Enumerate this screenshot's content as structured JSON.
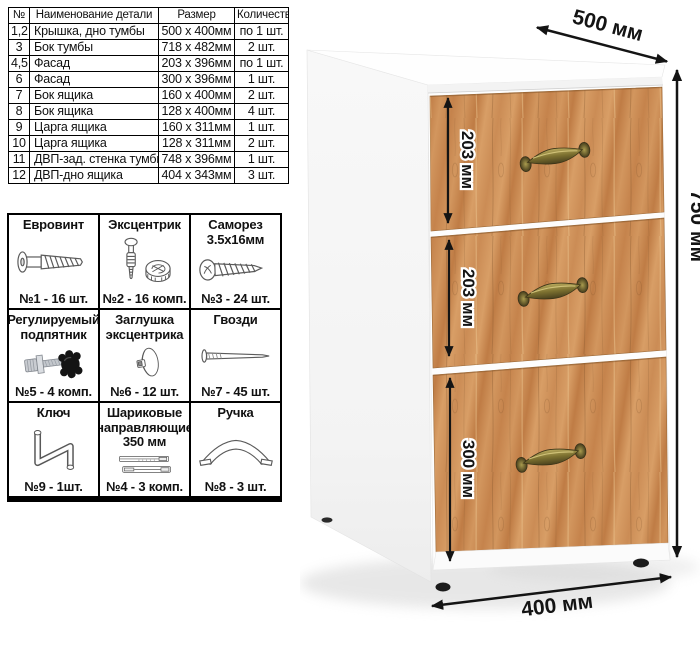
{
  "parts_table": {
    "headers": [
      "№",
      "Наименование детали",
      "Размер",
      "Количество"
    ],
    "rows": [
      [
        "1,2",
        "Крышка, дно тумбы",
        "500 х 400мм",
        "по 1 шт."
      ],
      [
        "3",
        "Бок тумбы",
        "718 х 482мм",
        "2 шт."
      ],
      [
        "4,5",
        "Фасад",
        "203 х 396мм",
        "по 1 шт."
      ],
      [
        "6",
        "Фасад",
        "300 х 396мм",
        "1 шт."
      ],
      [
        "7",
        "Бок ящика",
        "160 х 400мм",
        "2 шт."
      ],
      [
        "8",
        "Бок ящика",
        "128 х 400мм",
        "4 шт."
      ],
      [
        "9",
        "Царга ящика",
        "160 х 311мм",
        "1 шт."
      ],
      [
        "10",
        "Царга ящика",
        "128 х 311мм",
        "2 шт."
      ],
      [
        "11",
        "ДВП-зад. стенка тумбы",
        "748 х 396мм",
        "1 шт."
      ],
      [
        "12",
        "ДВП-дно ящика",
        "404 х 343мм",
        "3 шт."
      ]
    ]
  },
  "hardware": {
    "cells": [
      {
        "icon": "euro-screw",
        "title_lines": [
          "Евровинт"
        ],
        "count": "№1 - 16 шт."
      },
      {
        "icon": "cam-lock",
        "title_lines": [
          "Эксцентрик"
        ],
        "count": "№2 - 16 комп."
      },
      {
        "icon": "self-screw",
        "title_lines": [
          "Саморез",
          "3.5х16мм"
        ],
        "count": "№3 - 24 шт."
      },
      {
        "icon": "adj-foot",
        "title_lines": [
          "Регулируемый",
          "подпятник"
        ],
        "count": "№5 - 4 комп."
      },
      {
        "icon": "cam-cover",
        "title_lines": [
          "Заглушка",
          "эксцентрика"
        ],
        "count": "№6 - 12 шт."
      },
      {
        "icon": "nail",
        "title_lines": [
          "Гвозди"
        ],
        "count": "№7 - 45 шт."
      },
      {
        "icon": "hex-key",
        "title_lines": [
          "Ключ"
        ],
        "count": "№9 - 1шт."
      },
      {
        "icon": "ball-slides",
        "title_lines": [
          "Шариковые",
          "направляющие",
          "350 мм"
        ],
        "count": "№4 - 3 комп."
      },
      {
        "icon": "bow-handle",
        "title_lines": [
          "Ручка"
        ],
        "count": "№8 - 3 шт."
      }
    ]
  },
  "cabinet": {
    "dim_depth": "500 мм",
    "dim_height": "750 мм",
    "dim_width": "400 мм",
    "dim_drawer1": "203 мм",
    "dim_drawer2": "203 мм",
    "dim_drawer3": "300 мм"
  },
  "colors": {
    "wood": "#c88a52",
    "wood_dark": "#b9763f",
    "wood_light": "#d9a069",
    "brass": "#8b7f3a",
    "arrow": "#141414",
    "border": "#000000",
    "cabinet_white": "#fcfcfc"
  }
}
